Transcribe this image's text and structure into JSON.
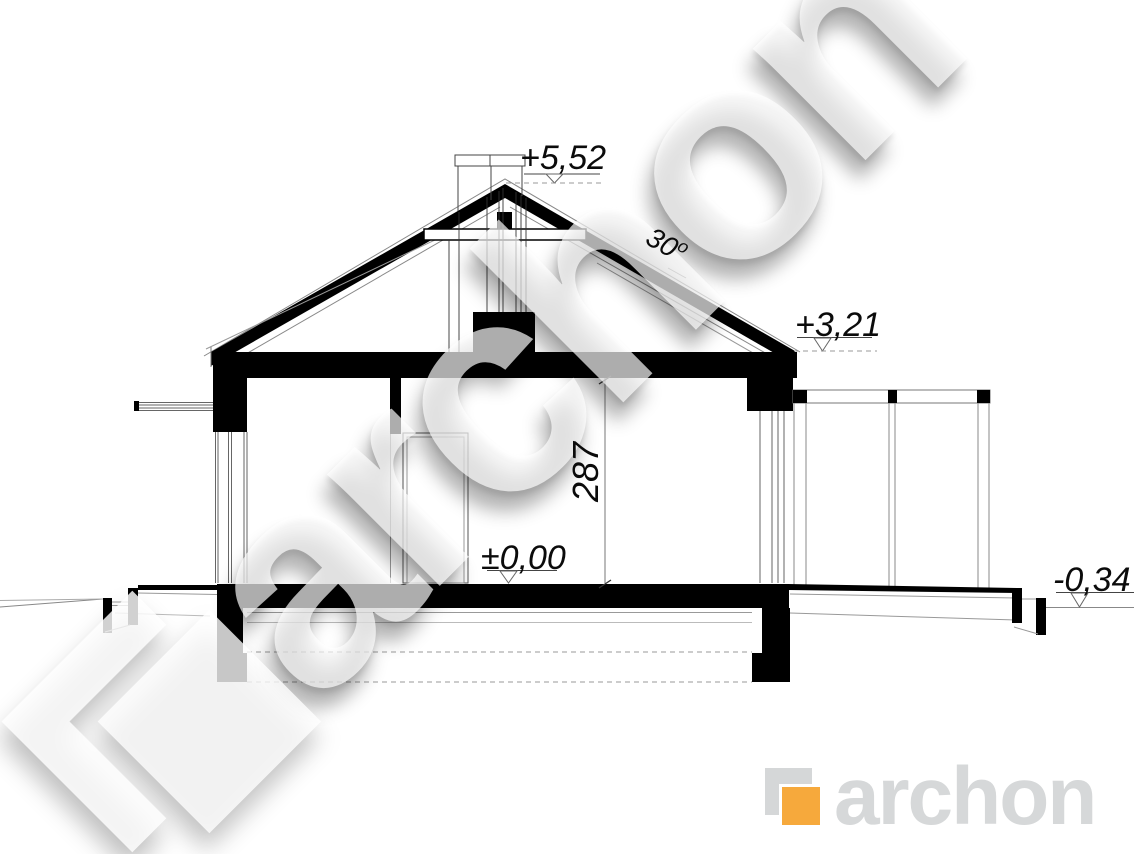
{
  "drawing": {
    "title": "house-cross-section",
    "annotations": {
      "ridge_level": "+5,52",
      "roof_angle_value": "30",
      "roof_angle_unit": "o",
      "wall_plate_level": "+3,21",
      "room_height": "287",
      "floor_level": "±0,00",
      "terrain_level": "-0,34"
    }
  },
  "watermark": {
    "text": "archon"
  },
  "logo": {
    "text": "archon"
  },
  "colors": {
    "ink": "#000000",
    "thin_line": "#777777",
    "logo_orange": "#f6a93c",
    "logo_gray": "#d6d8d9"
  }
}
